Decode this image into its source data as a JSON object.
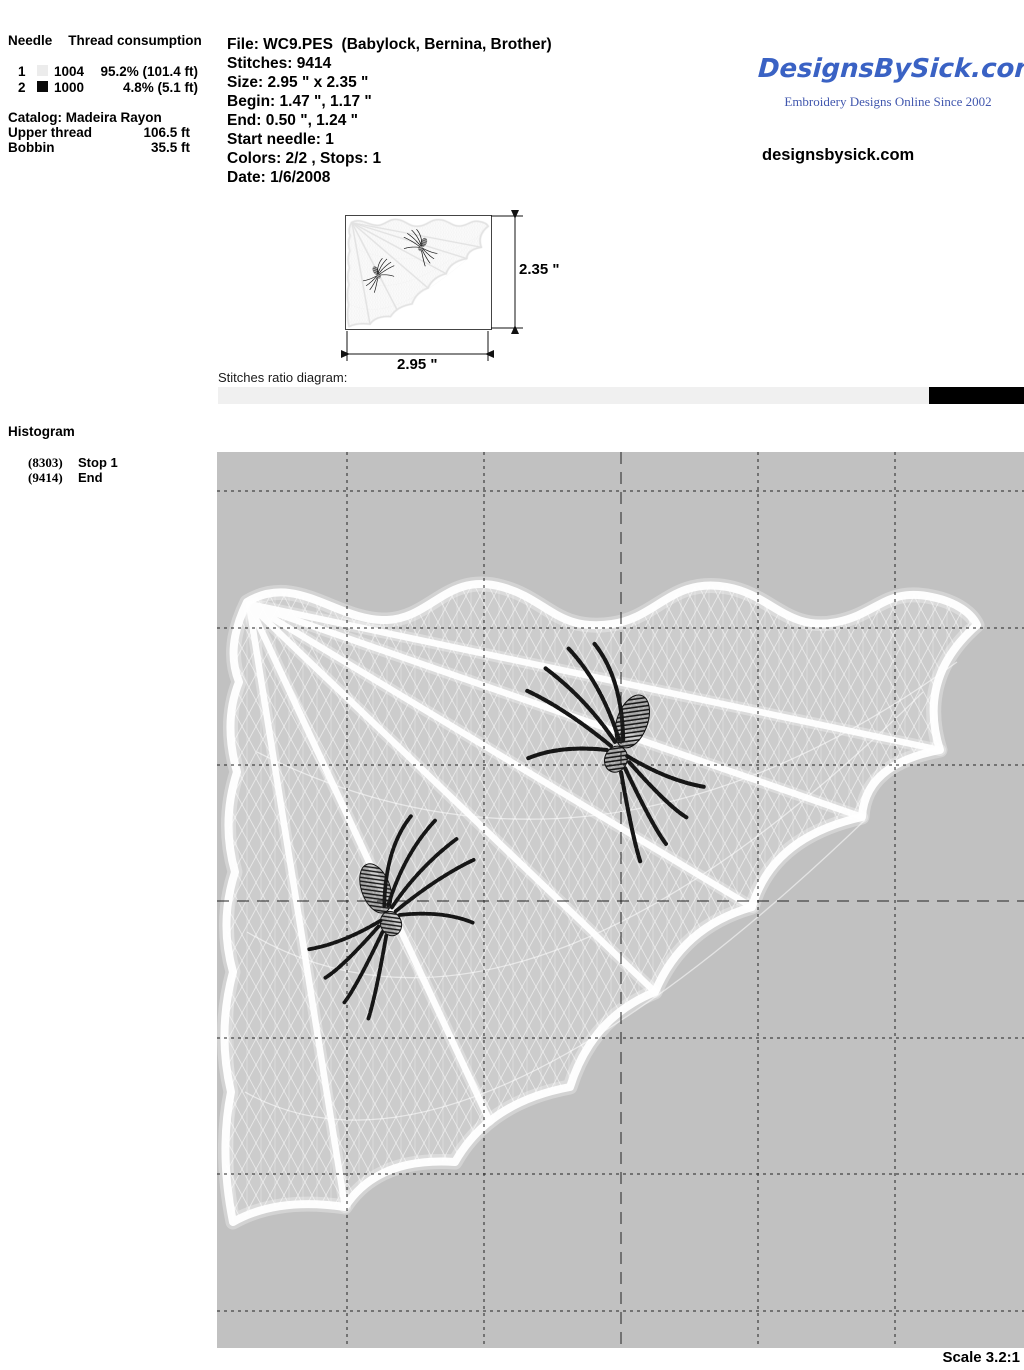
{
  "needle_table": {
    "header_needle": "Needle",
    "header_consumption": "Thread consumption",
    "rows": [
      {
        "needle": "1",
        "color": "#ececec",
        "thread": "1004",
        "consumption": "95.2% (101.4 ft)"
      },
      {
        "needle": "2",
        "color": "#0a0a0a",
        "thread": "1000",
        "consumption": "4.8% (5.1 ft)"
      }
    ],
    "catalog": "Catalog: Madeira Rayon",
    "upper_thread_label": "Upper thread",
    "upper_thread_value": "106.5 ft",
    "bobbin_label": "Bobbin",
    "bobbin_value": "35.5 ft"
  },
  "file_info": {
    "lines": [
      "File: WC9.PES  (Babylock, Bernina, Brother)",
      "Stitches: 9414",
      "Size: 2.95 \" x 2.35 \"",
      "Begin: 1.47 \", 1.17 \"",
      "End: 0.50 \", 1.24 \"",
      "Start needle: 1",
      "Colors: 2/2 , Stops: 1",
      "Date: 1/6/2008"
    ]
  },
  "branding": {
    "logo_text": "DesignsBySick.com",
    "tagline": "Embroidery Designs Online Since 2002",
    "website": "designsbysick.com",
    "logo_color": "#3a62c4",
    "tagline_color": "#4157ae"
  },
  "preview": {
    "height_label": "2.35 \"",
    "width_label": "2.95 \""
  },
  "ratio_diagram": {
    "label": "Stitches ratio diagram:",
    "segments": [
      {
        "color": "#f0f0f0",
        "percent": 88.2
      },
      {
        "color": "#000000",
        "percent": 11.8
      }
    ]
  },
  "histogram": {
    "title": "Histogram",
    "entries": [
      {
        "count": "(8303)",
        "label": "Stop 1"
      },
      {
        "count": "(9414)",
        "label": "End"
      }
    ]
  },
  "canvas": {
    "background": "#c1c1c1",
    "scale_label": "Scale 3.2:1"
  }
}
